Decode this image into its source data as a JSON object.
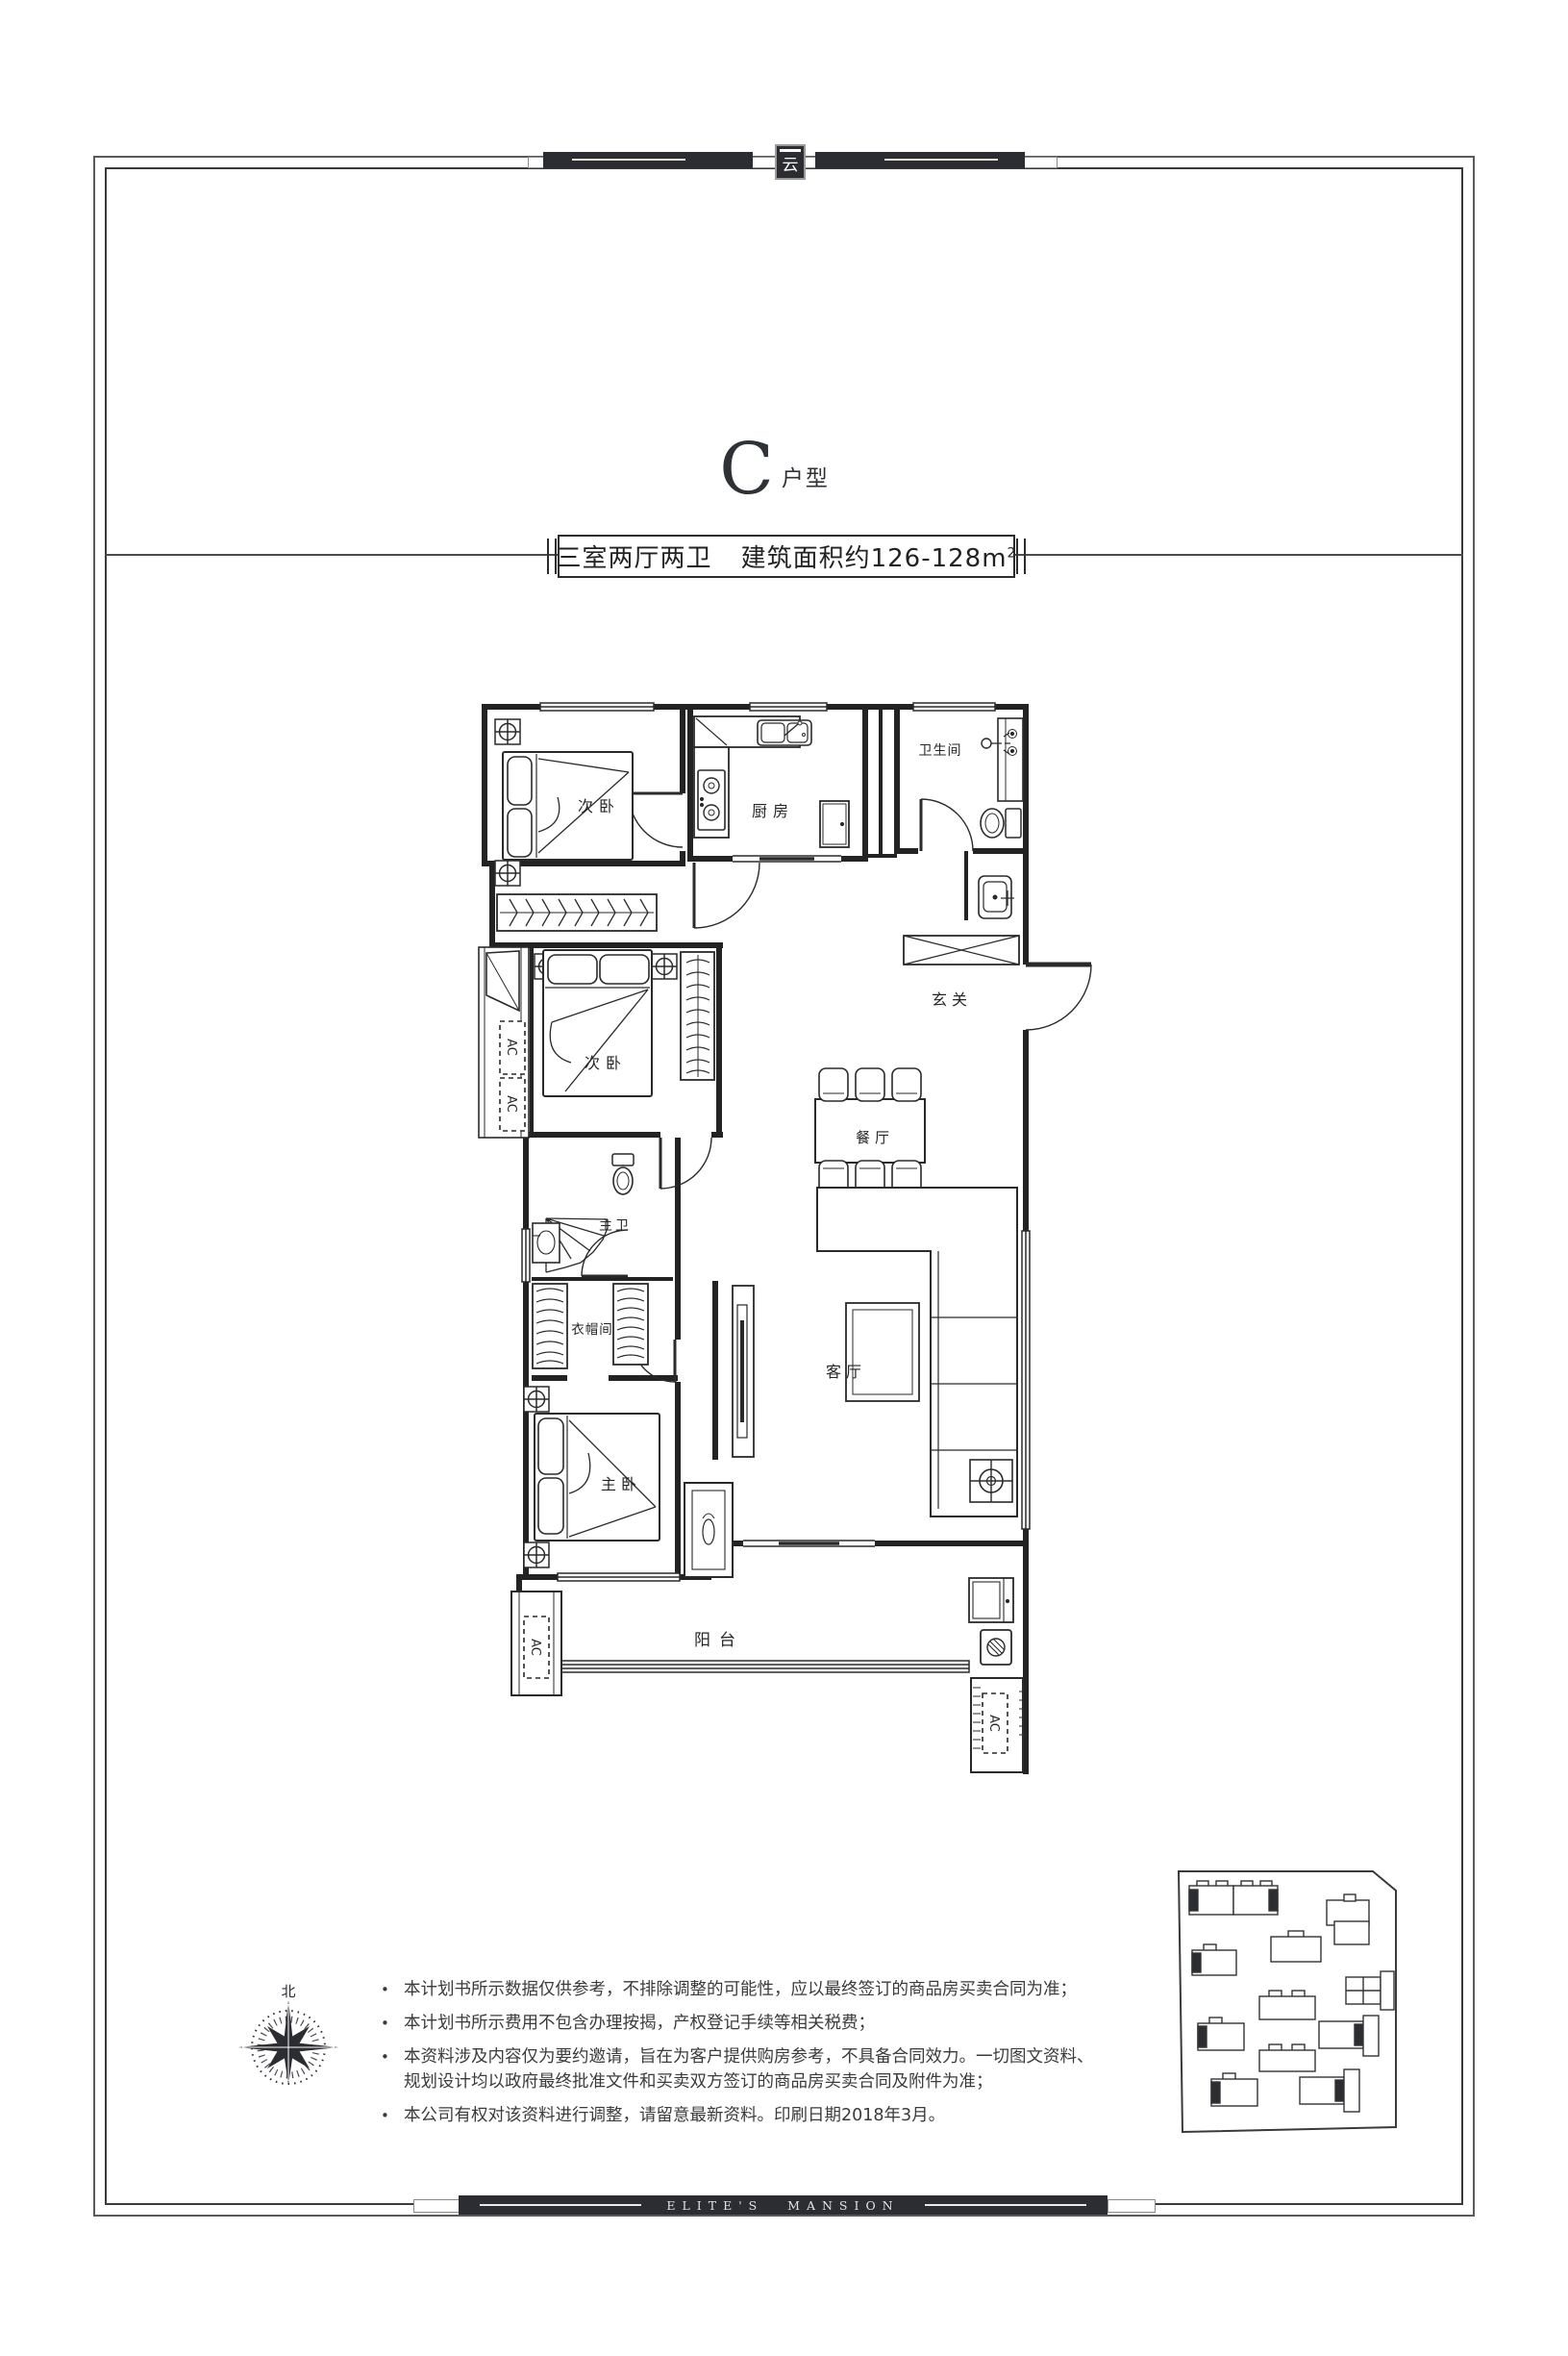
{
  "header": {
    "logo_glyph": "云"
  },
  "title": {
    "letter": "C",
    "suffix": "户型"
  },
  "banner": {
    "layout_text": "三室两厅两卫",
    "area_text": "建筑面积约126-128m",
    "area_sup": "2"
  },
  "floorplan": {
    "rooms": {
      "bedroom1": "次卧",
      "kitchen": "厨房",
      "bathroom": "卫生间",
      "foyer": "玄关",
      "bedroom2": "次卧",
      "dining": "餐厅",
      "master_bath": "主卫",
      "closet": "衣帽间",
      "master_bedroom": "主卧",
      "living": "客厅",
      "balcony": "阳台",
      "ac1": "AC",
      "ac2": "AC",
      "ac3": "AC",
      "ac4": "AC"
    }
  },
  "compass": {
    "north": "北"
  },
  "disclaimer": {
    "bullet": "•",
    "items": [
      "本计划书所示数据仅供参考，不排除调整的可能性，应以最终签订的商品房买卖合同为准；",
      "本计划书所示费用不包含办理按揭，产权登记手续等相关税费；",
      "本资料涉及内容仅为要约邀请，旨在为客户提供购房参考，不具备合同效力。一切图文资料、规划设计均以政府最终批准文件和买卖双方签订的商品房买卖合同及附件为准；",
      "本公司有权对该资料进行调整，请留意最新资料。印刷日期2018年3月。"
    ]
  },
  "footer": {
    "brand": "ELITE'S MANSION"
  }
}
